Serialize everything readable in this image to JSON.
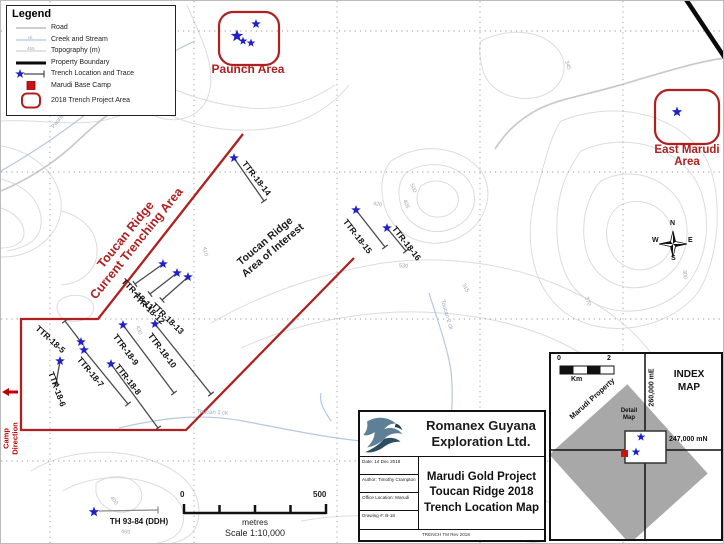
{
  "legend": {
    "title": "Legend",
    "items": [
      {
        "label": "Road"
      },
      {
        "label": "Creek and Stream",
        "sample": "ck"
      },
      {
        "label": "Topography (m)",
        "sample": "465"
      },
      {
        "label": "Property Boundary"
      },
      {
        "label": "Trench Location and Trace"
      },
      {
        "label": "Marudi Base Camp"
      },
      {
        "label": "2018 Trench Project Area"
      }
    ]
  },
  "areas": {
    "paunch": {
      "label": "Paunch Area"
    },
    "east_marudi": {
      "line1": "East Marudi",
      "line2": "Area"
    }
  },
  "annotations": {
    "trenching_line1": "Toucan Ridge",
    "trenching_line2": "Current Trenching Area",
    "interest_line1": "Toucan Ridge",
    "interest_line2": "Area of Interest",
    "camp_line1": "Camp",
    "camp_line2": "Direction"
  },
  "trenches": [
    {
      "name": "TTR-18-14",
      "star": [
        233,
        157
      ],
      "end": [
        263,
        200
      ],
      "label": {
        "x": 243,
        "y": 160,
        "rot": 52
      }
    },
    {
      "name": "TTR-18-15",
      "star": [
        355,
        209
      ],
      "end": [
        384,
        246
      ],
      "label": {
        "x": 344,
        "y": 218,
        "rot": 52
      }
    },
    {
      "name": "TTR-18-16",
      "star": [
        386,
        227
      ],
      "end": [
        405,
        250
      ],
      "label": {
        "x": 393,
        "y": 225,
        "rot": 52
      }
    },
    {
      "name": "TTR-18-11",
      "star": [
        162,
        263
      ],
      "end": [
        134,
        283
      ],
      "label": {
        "x": 122,
        "y": 278,
        "rot": 44
      }
    },
    {
      "name": "TTR-18-12",
      "star": [
        176,
        272
      ],
      "end": [
        149,
        293
      ],
      "label": {
        "x": 133,
        "y": 292,
        "rot": 44
      }
    },
    {
      "name": "TTR-18-13",
      "star": [
        187,
        276
      ],
      "end": [
        161,
        299
      ],
      "label": {
        "x": 152,
        "y": 302,
        "rot": 44
      }
    },
    {
      "name": "TTR-18-5",
      "star": [
        80,
        341
      ],
      "end": [
        64,
        320
      ],
      "label": {
        "x": 36,
        "y": 325,
        "rot": 42
      }
    },
    {
      "name": "TTR-18-6",
      "star": [
        59,
        360
      ],
      "end": [
        55,
        383
      ],
      "label": {
        "x": 50,
        "y": 370,
        "rot": 70
      }
    },
    {
      "name": "TTR-18-7",
      "star": [
        83,
        349
      ],
      "end": [
        127,
        403
      ],
      "label": {
        "x": 78,
        "y": 356,
        "rot": 50
      }
    },
    {
      "name": "TTR-18-8",
      "star": [
        110,
        363
      ],
      "end": [
        157,
        427
      ],
      "label": {
        "x": 116,
        "y": 363,
        "rot": 52
      }
    },
    {
      "name": "TTR-18-9",
      "star": [
        122,
        324
      ],
      "end": [
        173,
        392
      ],
      "label": {
        "x": 114,
        "y": 333,
        "rot": 53
      }
    },
    {
      "name": "TTR-18-10",
      "star": [
        154,
        323
      ],
      "end": [
        210,
        393
      ],
      "label": {
        "x": 149,
        "y": 332,
        "rot": 53
      }
    }
  ],
  "extra_stars": {
    "paunch": [
      [
        255,
        23,
        5
      ],
      [
        236,
        35,
        6.5
      ],
      [
        242,
        40,
        4.5
      ],
      [
        250,
        42,
        4.5
      ]
    ],
    "east_marudi": [
      [
        676,
        111,
        5.5
      ]
    ],
    "index_local": [
      [
        90,
        83,
        4.5
      ],
      [
        85,
        98,
        4.5
      ]
    ]
  },
  "ddh": {
    "label": "TH 93-84 (DDH)",
    "star": [
      93,
      511
    ],
    "line": [
      98,
      510,
      157,
      509
    ]
  },
  "contour_labels": [
    {
      "t": "345",
      "x": 565,
      "y": 61,
      "r": 72
    },
    {
      "t": "500",
      "x": 410,
      "y": 184,
      "r": 68
    },
    {
      "t": "405",
      "x": 403,
      "y": 200,
      "r": 68
    },
    {
      "t": "420",
      "x": 372,
      "y": 204,
      "r": 8
    },
    {
      "t": "530",
      "x": 398,
      "y": 266,
      "r": 5
    },
    {
      "t": "315",
      "x": 462,
      "y": 284,
      "r": 62
    },
    {
      "t": "410",
      "x": 203,
      "y": 247,
      "r": 80
    },
    {
      "t": "370",
      "x": 585,
      "y": 297,
      "r": 72
    },
    {
      "t": "300",
      "x": 683,
      "y": 270,
      "r": 85
    },
    {
      "t": "430",
      "x": 136,
      "y": 326,
      "r": 70
    },
    {
      "t": "400",
      "x": 110,
      "y": 497,
      "r": 55
    },
    {
      "t": "465",
      "x": 120,
      "y": 532,
      "r": 5
    }
  ],
  "creek_labels": [
    {
      "t": "Paunch ck",
      "x": 52,
      "y": 128,
      "r": -52
    },
    {
      "t": "Toucan 1 ck",
      "x": 196,
      "y": 412,
      "r": 3
    },
    {
      "t": "Toucan 2 ck",
      "x": 441,
      "y": 300,
      "r": 74
    }
  ],
  "scalebar": {
    "zero": "0",
    "max": "500",
    "unit": "metres",
    "ratio": "Scale 1:10,000"
  },
  "compass": {
    "n": "N",
    "e": "E",
    "s": "S",
    "w": "W"
  },
  "title_block": {
    "company_line1": "Romanex Guyana",
    "company_line2": "Exploration Ltd.",
    "cells": [
      {
        "text": "Date: 14 Dec 2018"
      },
      {
        "text": "Author: Timothy Crampton"
      },
      {
        "text": "Office Location: Marudi"
      },
      {
        "text": "Drawing #: B-18"
      }
    ],
    "title_line1": "Marudi Gold Project",
    "title_line2": "Toucan Ridge 2018",
    "title_line3": "Trench Location Map",
    "footer": "TRENCH TM Rev 2018"
  },
  "index_map": {
    "title_line1": "INDEX",
    "title_line2": "MAP",
    "km_zero": "0",
    "km_two": "2",
    "km_unit": "Km",
    "property": "Marudi Property",
    "easting": "260,000 mE",
    "northing": "247,000 mN",
    "detail_line1": "Detail",
    "detail_line2": "Map"
  },
  "grid": {
    "vx": [
      49,
      193,
      336,
      479,
      622
    ],
    "hy": [
      30,
      171,
      318,
      460
    ]
  },
  "colors": {
    "boundary_red": "#b02020",
    "star_blue": "#2121c8",
    "camp_red": "#cc1111"
  }
}
